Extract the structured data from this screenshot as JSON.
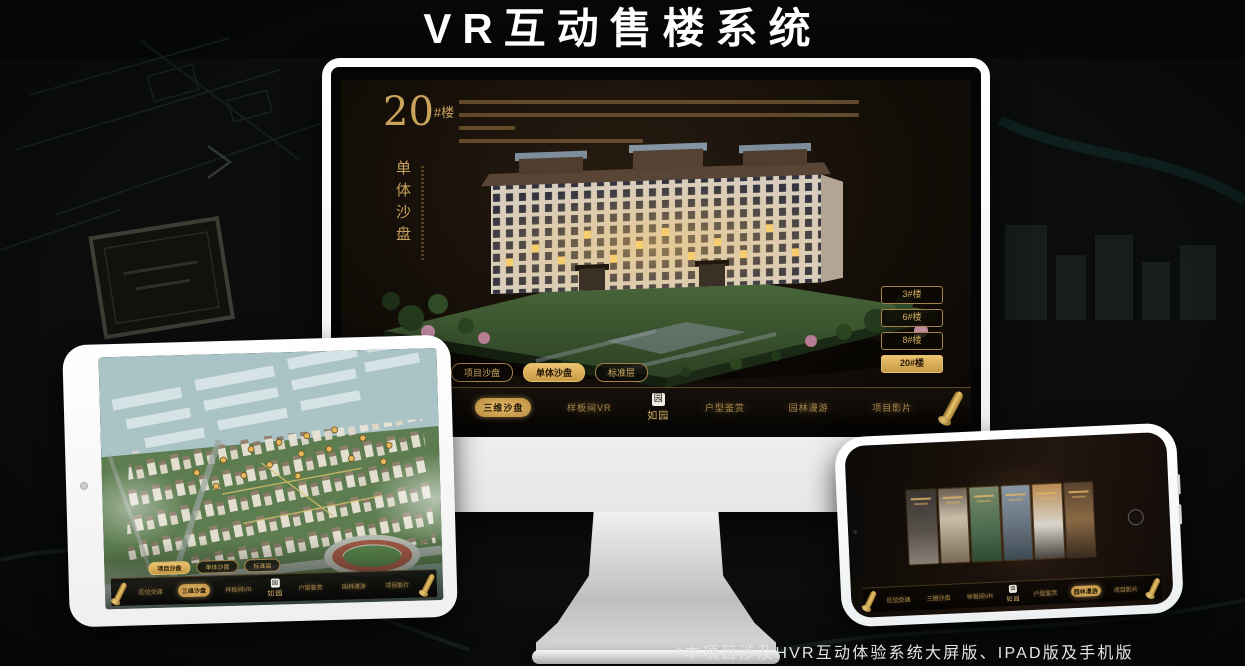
{
  "page": {
    "title": "VR互动售楼系统",
    "footnote": "*本项目涉及HVR互动体验系统大屏版、IPAD版及手机版"
  },
  "colors": {
    "gold": "#d2a659",
    "gold_dark": "#8a6a2a",
    "screen_bg": "#17100a",
    "device_white": "#f5f5f5"
  },
  "monitor": {
    "heading": {
      "number": "20",
      "unit": "#楼",
      "subtitle": "单体沙盘"
    },
    "floor_buttons": [
      {
        "label": "3#楼",
        "active": false
      },
      {
        "label": "6#楼",
        "active": false
      },
      {
        "label": "8#楼",
        "active": false
      },
      {
        "label": "20#楼",
        "active": true
      }
    ],
    "tabs": [
      {
        "label": "项目沙盘",
        "active": false
      },
      {
        "label": "单体沙盘",
        "active": true
      },
      {
        "label": "标准层",
        "active": false
      }
    ],
    "nav": {
      "items": [
        {
          "label": "区位交通",
          "active": false
        },
        {
          "label": "三维沙盘",
          "active": true
        },
        {
          "label": "样板间VR",
          "active": false
        },
        {
          "label": "户型鉴赏",
          "active": false
        },
        {
          "label": "园林漫游",
          "active": false
        },
        {
          "label": "项目影片",
          "active": false
        }
      ],
      "logo": {
        "seal": "园",
        "text": "如园"
      }
    }
  },
  "tablet": {
    "tabs": [
      {
        "label": "项目沙盘",
        "active": true
      },
      {
        "label": "单体沙盘",
        "active": false
      },
      {
        "label": "标准层",
        "active": false
      }
    ],
    "nav": {
      "items": [
        {
          "label": "区位交通",
          "active": false
        },
        {
          "label": "三维沙盘",
          "active": true
        },
        {
          "label": "样板间VR",
          "active": false
        },
        {
          "label": "户型鉴赏",
          "active": false
        },
        {
          "label": "园林漫游",
          "active": false
        },
        {
          "label": "项目影片",
          "active": false
        }
      ],
      "logo": {
        "seal": "园",
        "text": "如园"
      }
    }
  },
  "phone": {
    "nav": {
      "items": [
        {
          "label": "区位交通",
          "active": false
        },
        {
          "label": "三维沙盘",
          "active": false
        },
        {
          "label": "样板间VR",
          "active": false
        },
        {
          "label": "户型鉴赏",
          "active": false
        },
        {
          "label": "园林漫游",
          "active": true
        },
        {
          "label": "项目影片",
          "active": false
        }
      ],
      "logo": {
        "seal": "园",
        "text": "如园"
      }
    }
  }
}
